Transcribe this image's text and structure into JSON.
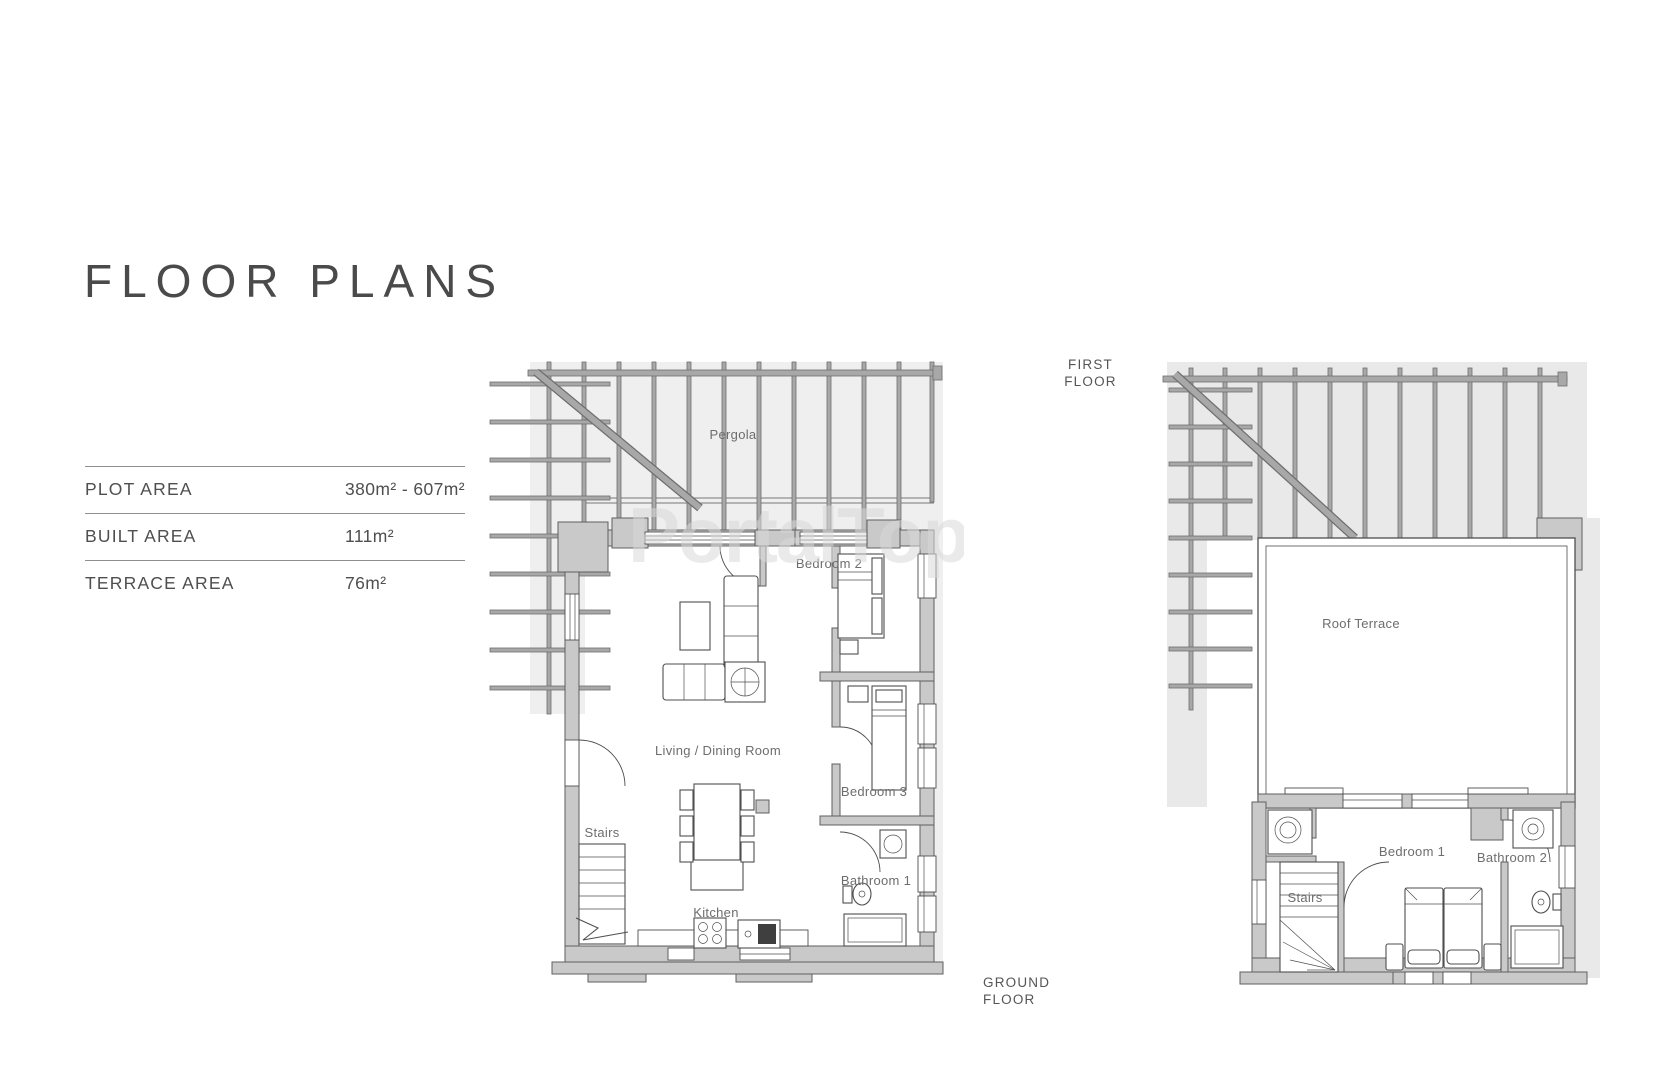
{
  "page": {
    "title": "FLOOR PLANS"
  },
  "area_table": {
    "rows": [
      {
        "label": "PLOT AREA",
        "value": "380m² - 607m²"
      },
      {
        "label": "BUILT AREA",
        "value": "111m²"
      },
      {
        "label": "TERRACE AREA",
        "value": "76m²"
      }
    ]
  },
  "watermark": "PortalTop",
  "plans": {
    "ground": {
      "caption_line1": "GROUND",
      "caption_line2": "FLOOR",
      "labels": {
        "pergola": "Pergola",
        "bedroom2": "Bedroom 2",
        "living": "Living / Dining Room",
        "bedroom3": "Bedroom 3",
        "stairs": "Stairs",
        "kitchen": "Kitchen",
        "bathroom1": "Bathroom 1"
      }
    },
    "first": {
      "caption_line1": "FIRST",
      "caption_line2": "FLOOR",
      "labels": {
        "roof_terrace": "Roof Terrace",
        "bedroom1": "Bedroom 1",
        "bathroom2": "Bathroom 2",
        "stairs": "Stairs"
      }
    }
  },
  "colors": {
    "wall": "#c9c9c9",
    "beam": "#a8a8a8",
    "backdrop": "#efefef",
    "linework": "#4f4f4f",
    "label_text": "#6d6d6d"
  }
}
